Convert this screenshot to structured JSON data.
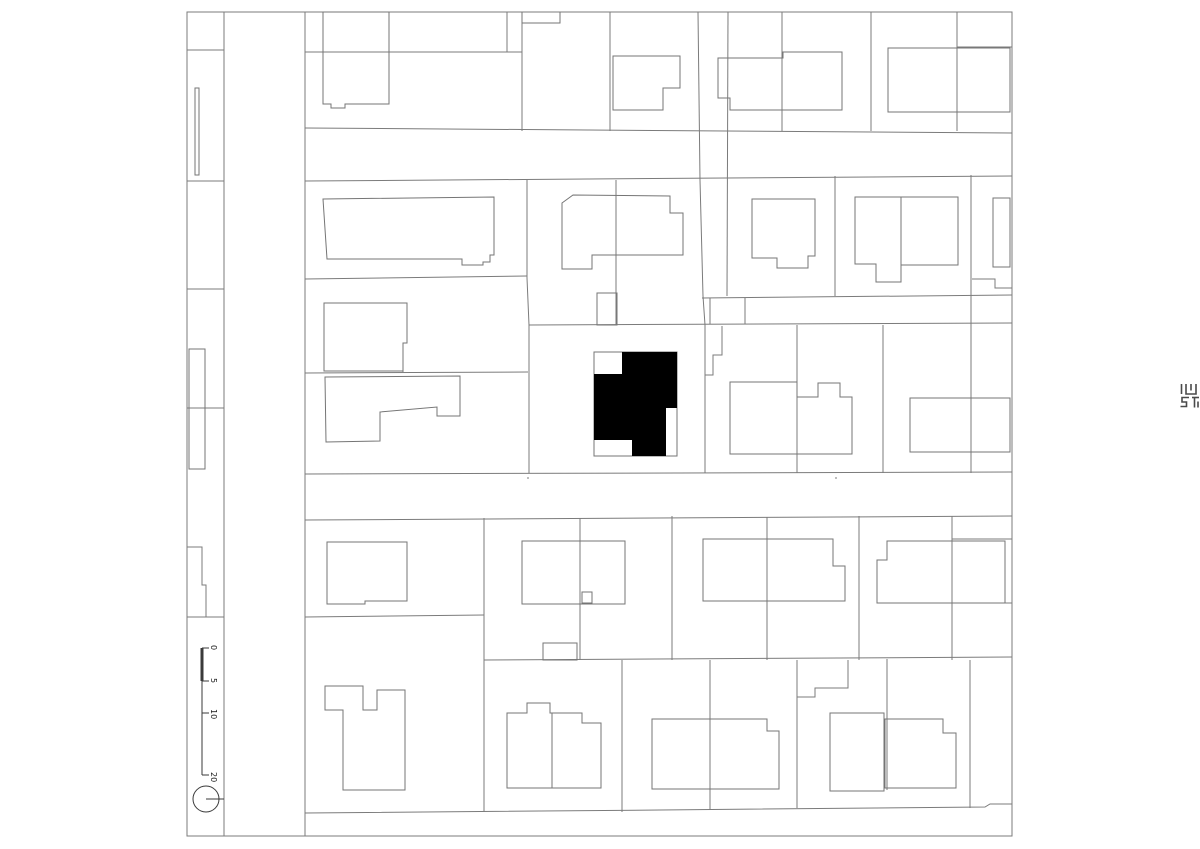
{
  "plan": {
    "scale_bar": {
      "labels": [
        "0",
        "5",
        "10",
        "20"
      ]
    },
    "colors": {
      "line": "#7b7b7b",
      "subject_building_fill": "#000000",
      "background": "#ffffff"
    },
    "icons": {
      "north_marker": "north-marker-circle",
      "logo_mark": "publisher-logo-mark"
    }
  }
}
